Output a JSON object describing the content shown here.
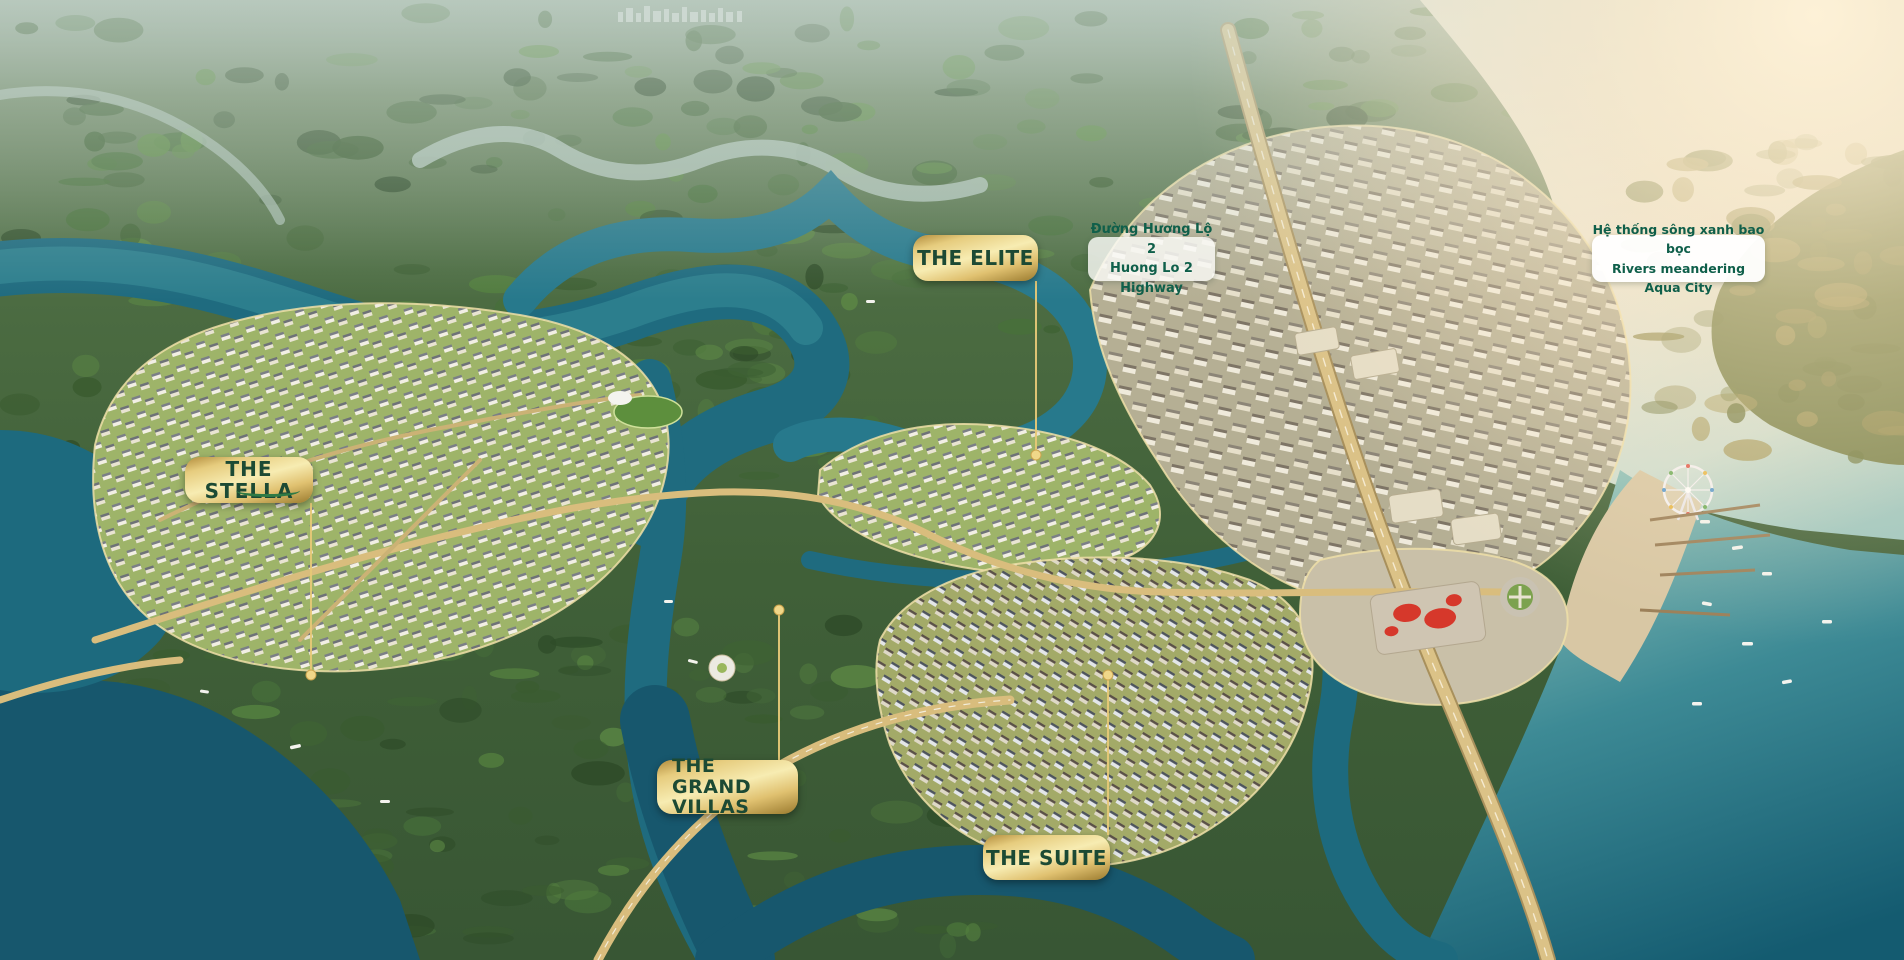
{
  "map_labels": {
    "elite": {
      "text": "THE ELITE"
    },
    "stella": {
      "text": "THE STELLA"
    },
    "grand_villas": {
      "line1": "THE GRAND",
      "line2": "VILLAS"
    },
    "suite": {
      "text": "THE SUITE"
    }
  },
  "annotations": {
    "highway": {
      "vi": "Đường Hương Lộ 2",
      "en": "Huong Lo 2 Highway"
    },
    "rivers": {
      "vi": "Hệ thống sông xanh bao bọc",
      "en": "Rivers meandering Aqua City"
    }
  },
  "colors": {
    "label_gold_light": "#f7ecb2",
    "label_gold_dark": "#9a7a2e",
    "label_text_green": "#1c4a34",
    "annotation_text_green": "#0f5f4a",
    "leader_line_gold": "#e6c877",
    "canal_teal": "#1f6b7f",
    "river_glare_cream": "#f4edda",
    "forest_green": "#3c5e30",
    "mall_roof_red": "#d6382b"
  }
}
